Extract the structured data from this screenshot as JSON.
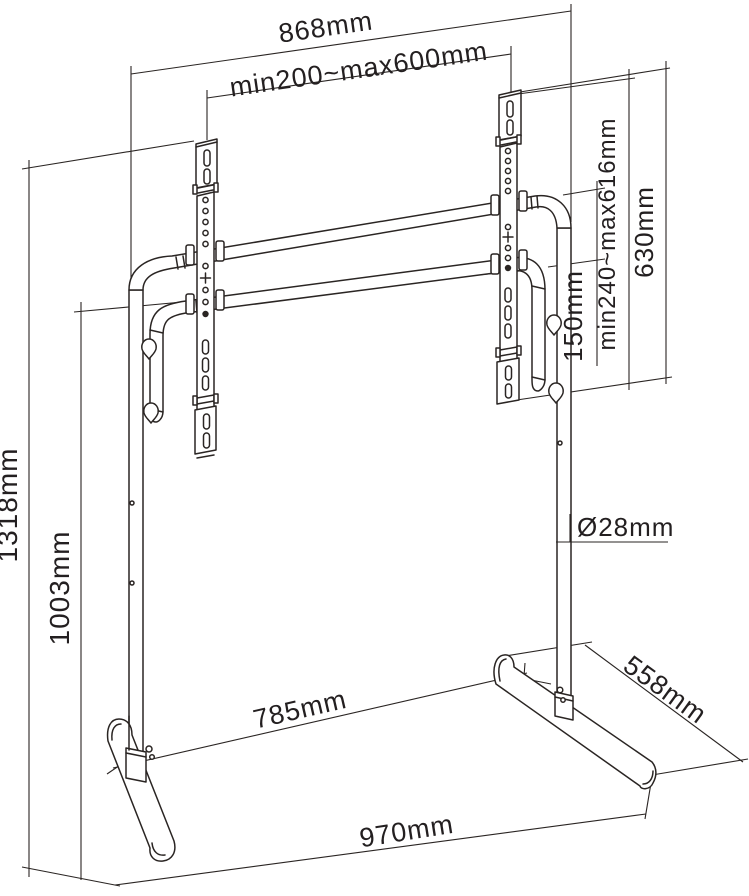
{
  "drawing": {
    "type": "technical-dimension-drawing",
    "subject": "TV floor stand with VESA mounting rails",
    "background_color": "#ffffff",
    "line_color": "#2a2523"
  },
  "labels": {
    "top_width": "868mm",
    "vesa_width_range": "min200~max600mm",
    "vesa_height_range": "min240~max616mm",
    "bracket_height": "630mm",
    "crossbar_spacing": "150mm",
    "total_height": "1318mm",
    "pole_height": "1003mm",
    "pole_diameter": "Ø28mm",
    "feet_span": "785mm",
    "foot_depth": "558mm",
    "base_width": "970mm"
  }
}
